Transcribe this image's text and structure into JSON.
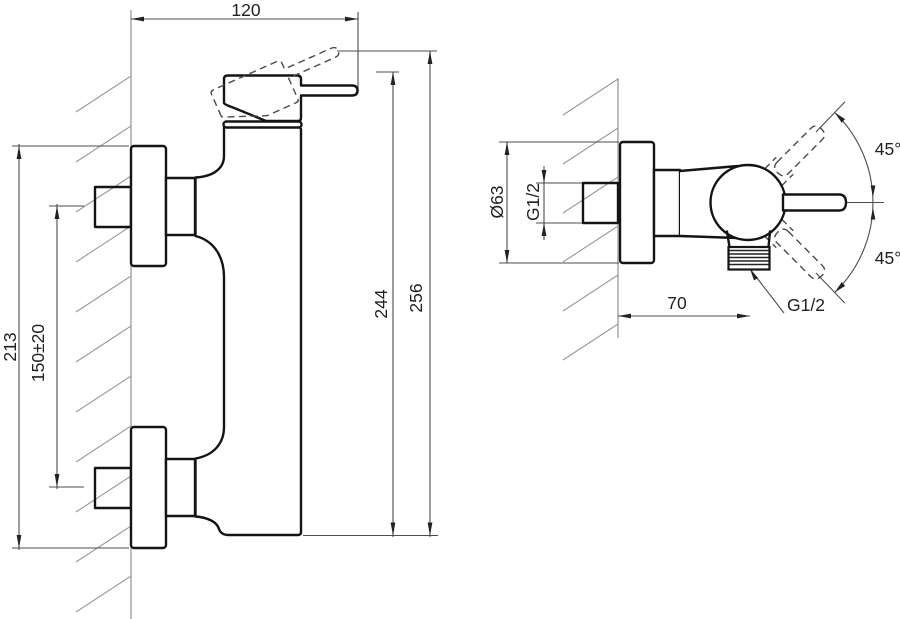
{
  "drawing": {
    "type": "technical-dimension-drawing",
    "units": "mm",
    "colors": {
      "background": "#ffffff",
      "outline": "#141414",
      "dimension_lines": "#4d4d4d",
      "hatching": "#9a9a9a",
      "text": "#1f1f1f"
    },
    "views": {
      "front": {
        "name": "front-view",
        "dimensions": [
          {
            "id": "wall-to-handle-tip",
            "label": "120",
            "value": 120,
            "orientation": "horizontal"
          },
          {
            "id": "overall-height-escutcheons",
            "label": "213",
            "value": 213,
            "orientation": "vertical"
          },
          {
            "id": "supply-connection-pitch",
            "label": "150±20",
            "value": 150,
            "tolerance": 20,
            "orientation": "vertical"
          },
          {
            "id": "height-to-lever",
            "label": "244",
            "value": 244,
            "orientation": "vertical"
          },
          {
            "id": "height-to-lever-raised",
            "label": "256",
            "value": 256,
            "orientation": "vertical"
          }
        ]
      },
      "side": {
        "name": "side-view",
        "dimensions": [
          {
            "id": "escutcheon-diameter",
            "label": "Ø63",
            "value": 63,
            "orientation": "vertical"
          },
          {
            "id": "supply-thread",
            "label": "G1/2",
            "orientation": "vertical"
          },
          {
            "id": "wall-to-outlet-axis",
            "label": "70",
            "value": 70,
            "orientation": "horizontal"
          },
          {
            "id": "outlet-thread",
            "label": "G1/2",
            "leader": true
          },
          {
            "id": "lever-angle-up",
            "label": "45°",
            "value": 45
          },
          {
            "id": "lever-angle-down",
            "label": "45°",
            "value": 45
          }
        ]
      }
    }
  }
}
